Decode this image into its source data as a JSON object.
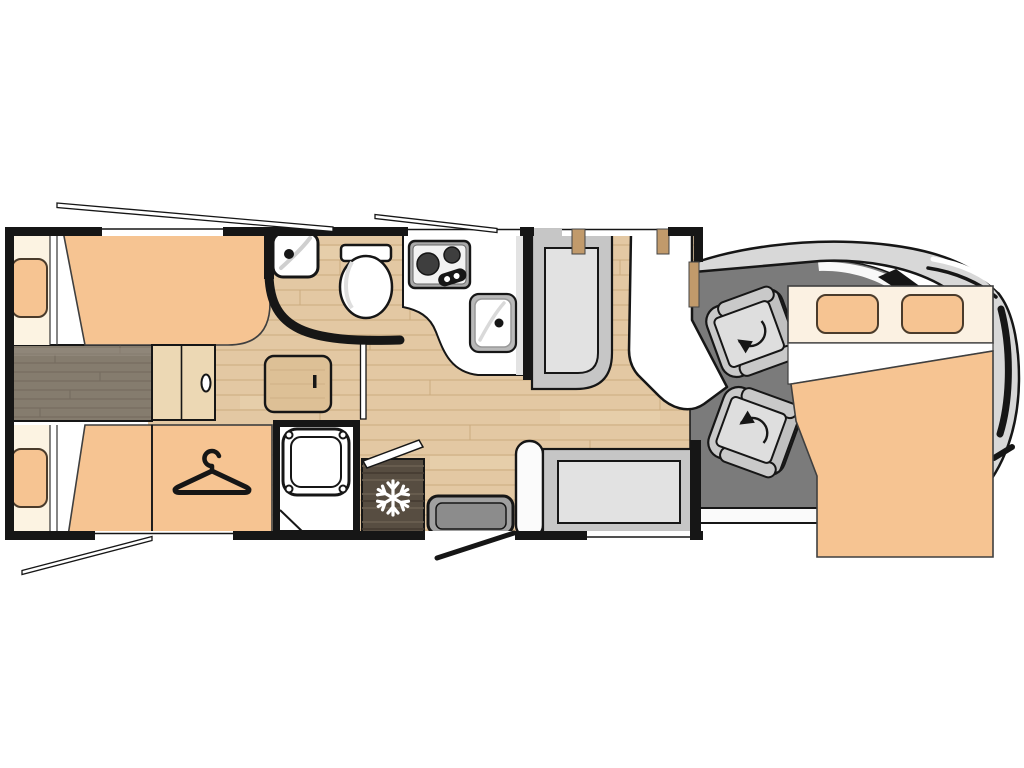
{
  "document": {
    "title": "Motorhome floor plan (top view)",
    "canvas": {
      "width": 1024,
      "height": 768
    },
    "background": "#ffffff"
  },
  "palette": {
    "wall": "#161616",
    "orange": "#f6c492",
    "cream": "#fcf3e2",
    "bed_header": "#fbf1e2",
    "wood": "#e3c8a3",
    "wood_line": "#b99463",
    "wood_light": "#f0debc",
    "walkway": "#857c6e",
    "walkway_line": "#6d6457",
    "trim_tan": "#c19a6b",
    "fridge_wood": "#574d41",
    "fridge_grain_light": "#6b6052",
    "fridge_grain_dark": "#453b31",
    "fixture_white": "#ffffff",
    "steel_gray": "#a9a9a9",
    "sink_gray": "#b9b9b9",
    "burner_dark": "#3e3e3e",
    "bench_gray": "#c6c6c6",
    "cushion_gray": "#e2e2e2",
    "seat_gray": "#c9c9c9",
    "seat_cushion": "#dedede",
    "cab_floor": "#7b7b7b",
    "body_gray": "#d8d8d8",
    "step_gray": "#a0a0a0",
    "step_inner": "#8c8c8c",
    "pillar_white": "#fbfbfb",
    "counter_edge": "#e3e3e3",
    "outline_soft": "#3f3f3f",
    "pillow_outline": "#4a3b2b",
    "swoosh_gray": "#cfcfcf"
  },
  "floorplan": {
    "view": "top-down",
    "vehicle_type": "motorhome",
    "zones": [
      {
        "id": "rear-bedroom",
        "label": "Rear twin single beds with center walkway and step"
      },
      {
        "id": "wardrobe",
        "label": "Wardrobe with clothes hanger symbol"
      },
      {
        "id": "washroom",
        "label": "Washroom with corner basin and toilet behind curved wall"
      },
      {
        "id": "shower",
        "label": "Separate shower cubicle with tray"
      },
      {
        "id": "kitchen",
        "label": "Kitchen with two-burner hob and sink"
      },
      {
        "id": "refrigerator",
        "label": "Refrigerator with snowflake symbol"
      },
      {
        "id": "dinette",
        "label": "Dinette with table, forward bench and side bench"
      },
      {
        "id": "entrance",
        "label": "Entry door with inside step and door swing"
      },
      {
        "id": "cab",
        "label": "Driver cab with two swivel seats"
      },
      {
        "id": "drop-down-bed",
        "label": "Drop-down double bed over the cab with two pillows"
      }
    ],
    "counts": {
      "single_beds": 2,
      "drop_down_beds": 1,
      "pillows_rear": 2,
      "pillows_front": 2,
      "swivel_seats": 2,
      "burners": 2,
      "sinks": 2
    },
    "icons": [
      "hanger-icon",
      "snowflake-icon",
      "swivel-arrow-icon",
      "faucet-dot-icon",
      "burner-icon"
    ]
  }
}
